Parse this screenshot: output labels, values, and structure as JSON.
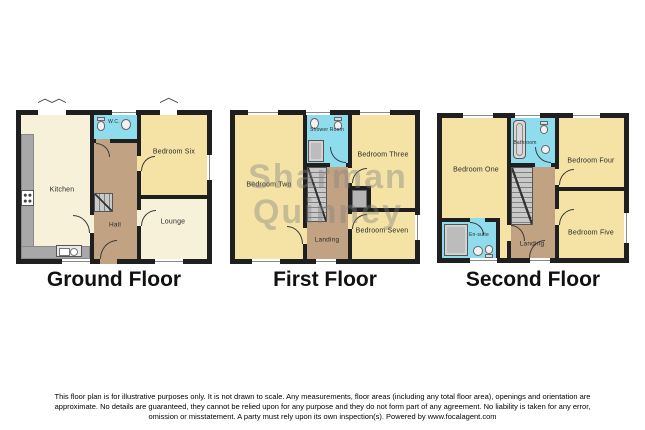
{
  "watermark": {
    "line1": "Sharman",
    "line2": "Quinney"
  },
  "ground": {
    "title": "Ground Floor",
    "kitchen": "Kitchen",
    "wc": "W.C.",
    "bedroom_six": "Bedroom Six",
    "hall": "Hall",
    "lounge": "Lounge"
  },
  "first": {
    "title": "First Floor",
    "bedroom_two": "Bedroom Two",
    "shower_room": "Shower Room",
    "bedroom_three": "Bedroom Three",
    "landing": "Landing",
    "bedroom_seven": "Bedroom Seven"
  },
  "second": {
    "title": "Second Floor",
    "bedroom_one": "Bedroom One",
    "bathroom": "Bathroom",
    "bedroom_four": "Bedroom Four",
    "landing": "Landing",
    "bedroom_five": "Bedroom Five",
    "ensuite": "En-suite"
  },
  "disclaimer": "This floor plan is for illustrative purposes only. It is not drawn to scale. Any measurements, floor areas (including any total floor area), openings and orientation are approximate. No details are guaranteed, they cannot be relied upon for any purpose and they do not form part of any agreement. No liability is taken for any error, omission or misstatement. A party must rely upon its own inspection(s). Powered by www.focalagent.com",
  "colors": {
    "wall": "#1f1f1f",
    "bedroom": "#f4e3a4",
    "living": "#f7f1da",
    "hall_landing": "#c1a283",
    "wet_room": "#8fdcec",
    "counter": "#a8a8a8",
    "stairs": "#c9c9c9",
    "watermark_gray": "#808080"
  }
}
